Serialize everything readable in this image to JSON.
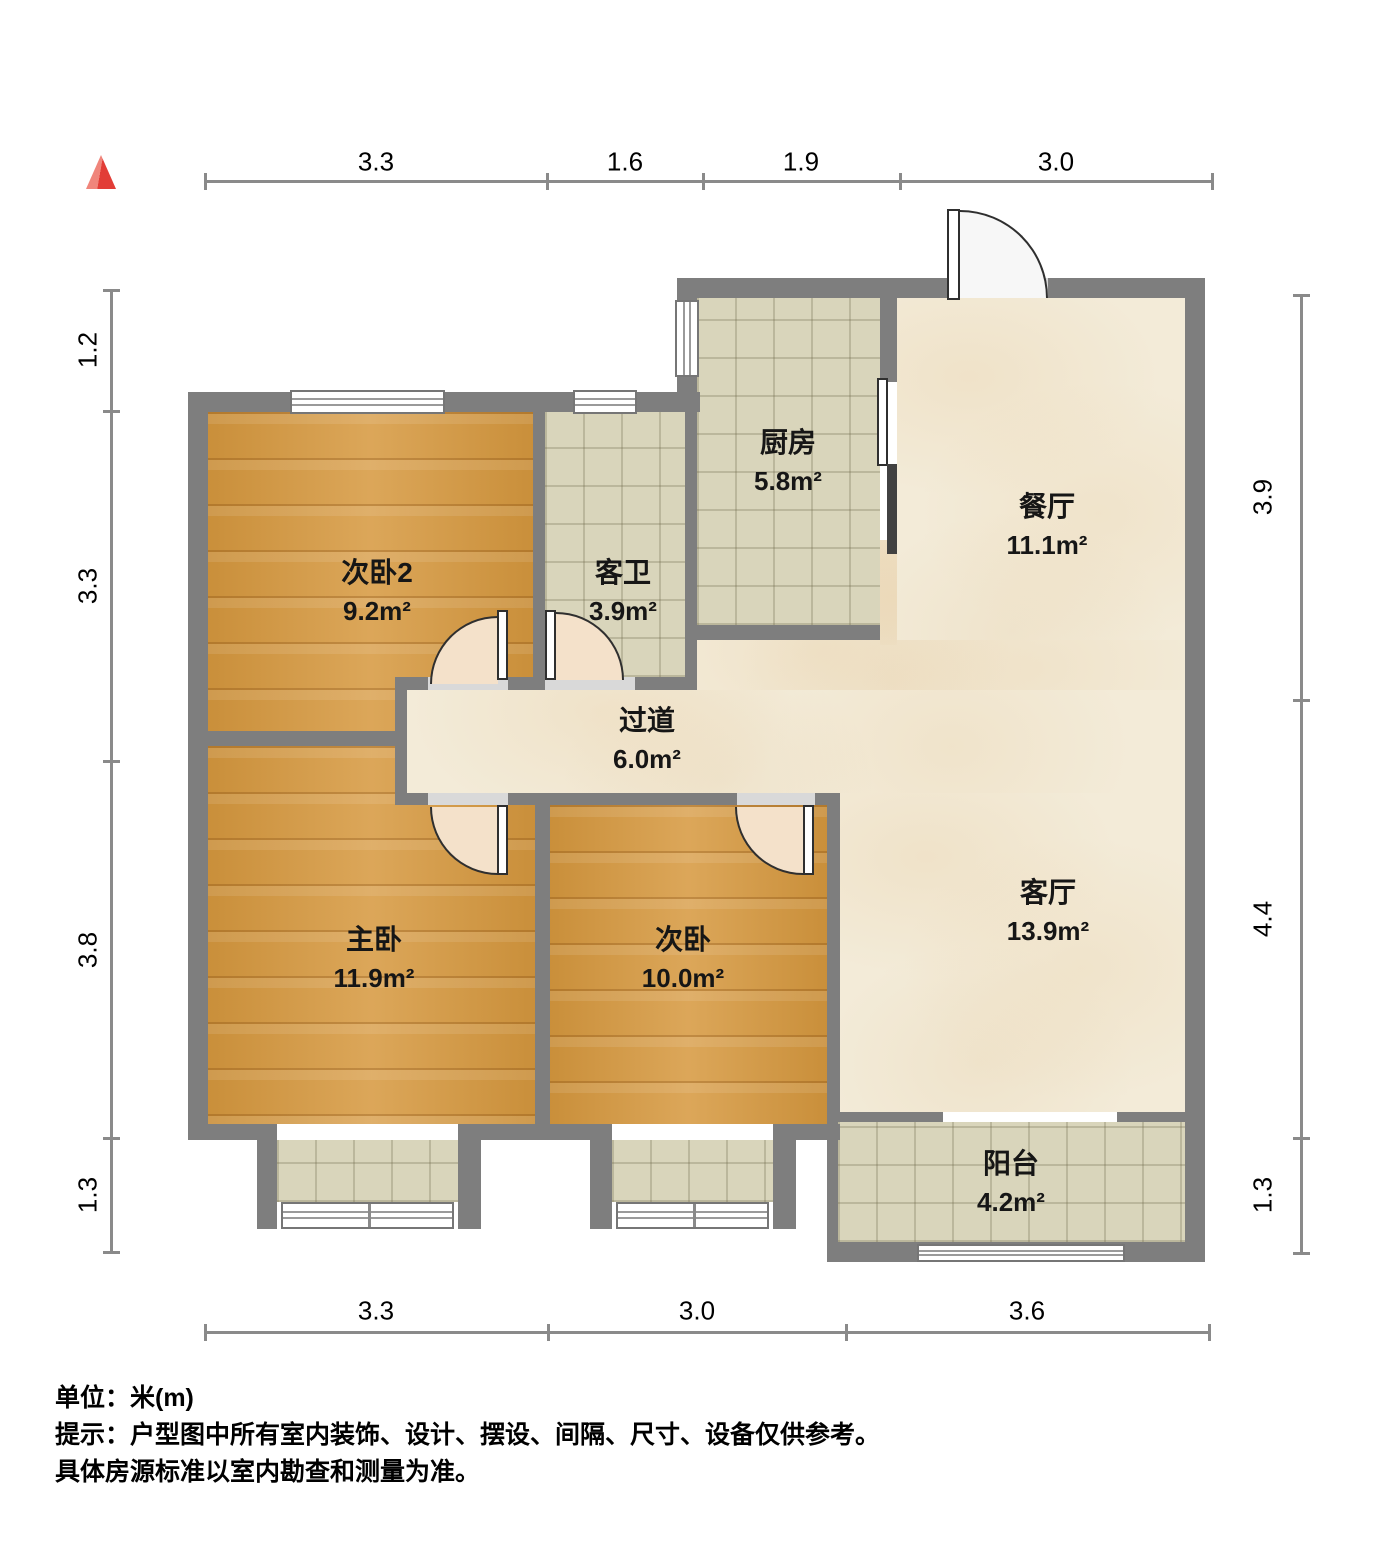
{
  "legend": {
    "unit": "单位：米(m)",
    "tip1": "提示：户型图中所有室内装饰、设计、摆设、间隔、尺寸、设备仅供参考。",
    "tip2": "具体房源标准以室内勘查和测量为准。"
  },
  "rooms": [
    {
      "id": "bedroom2",
      "name": "次卧2",
      "area": "9.2m²",
      "floor": "wood"
    },
    {
      "id": "guest-bathroom",
      "name": "客卫",
      "area": "3.9m²",
      "floor": "tile"
    },
    {
      "id": "kitchen",
      "name": "厨房",
      "area": "5.8m²",
      "floor": "tile"
    },
    {
      "id": "dining-room",
      "name": "餐厅",
      "area": "11.1m²",
      "floor": "marble"
    },
    {
      "id": "hallway",
      "name": "过道",
      "area": "6.0m²",
      "floor": "marble"
    },
    {
      "id": "master-bedroom",
      "name": "主卧",
      "area": "11.9m²",
      "floor": "wood"
    },
    {
      "id": "bedroom",
      "name": "次卧",
      "area": "10.0m²",
      "floor": "wood"
    },
    {
      "id": "living-room",
      "name": "客厅",
      "area": "13.9m²",
      "floor": "marble"
    },
    {
      "id": "balcony",
      "name": "阳台",
      "area": "4.2m²",
      "floor": "tile"
    }
  ],
  "dimensions": {
    "top": [
      "3.3",
      "1.6",
      "1.9",
      "3.0"
    ],
    "bottom": [
      "3.3",
      "3.0",
      "3.6"
    ],
    "left": [
      "1.2",
      "3.3",
      "3.8",
      "1.3"
    ],
    "right": [
      "3.9",
      "4.4",
      "1.3"
    ]
  },
  "colors": {
    "wall": "#7e7e7e",
    "wood_floor": "#d6983e",
    "tile_floor": "#d9d5bb",
    "marble_floor": "#f3ebd8",
    "door_swing": "#f4e1ca",
    "north_arrow_red": "#e23d37"
  }
}
